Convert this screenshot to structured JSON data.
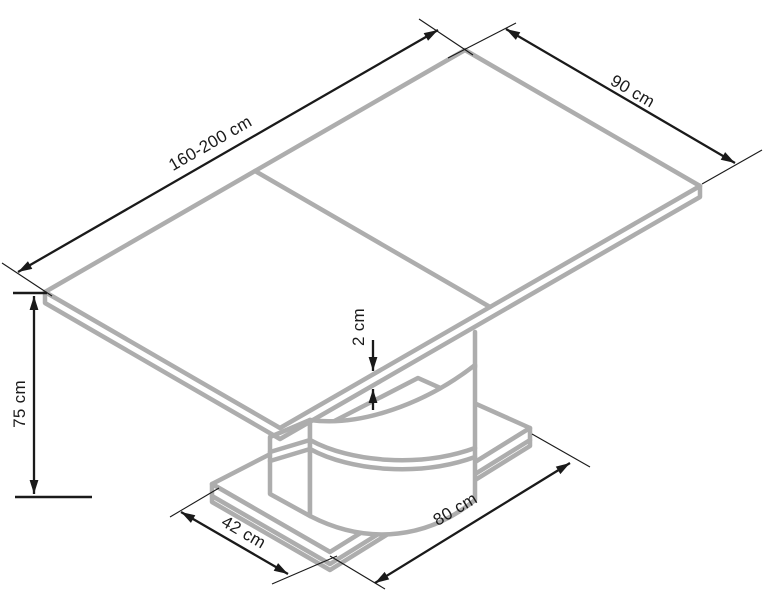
{
  "drawing": {
    "subject": "Extendable pedestal dining table — isometric dimension drawing",
    "colors": {
      "furniture_line": "#adadad",
      "dimension_line": "#1a1a1a",
      "background": "#ffffff"
    },
    "dimensions": {
      "tabletop_length": "160-200 cm",
      "tabletop_width": "90 cm",
      "table_height": "75 cm",
      "tabletop_thickness": "2 cm",
      "base_length": "80 cm",
      "base_depth": "42 cm"
    }
  }
}
